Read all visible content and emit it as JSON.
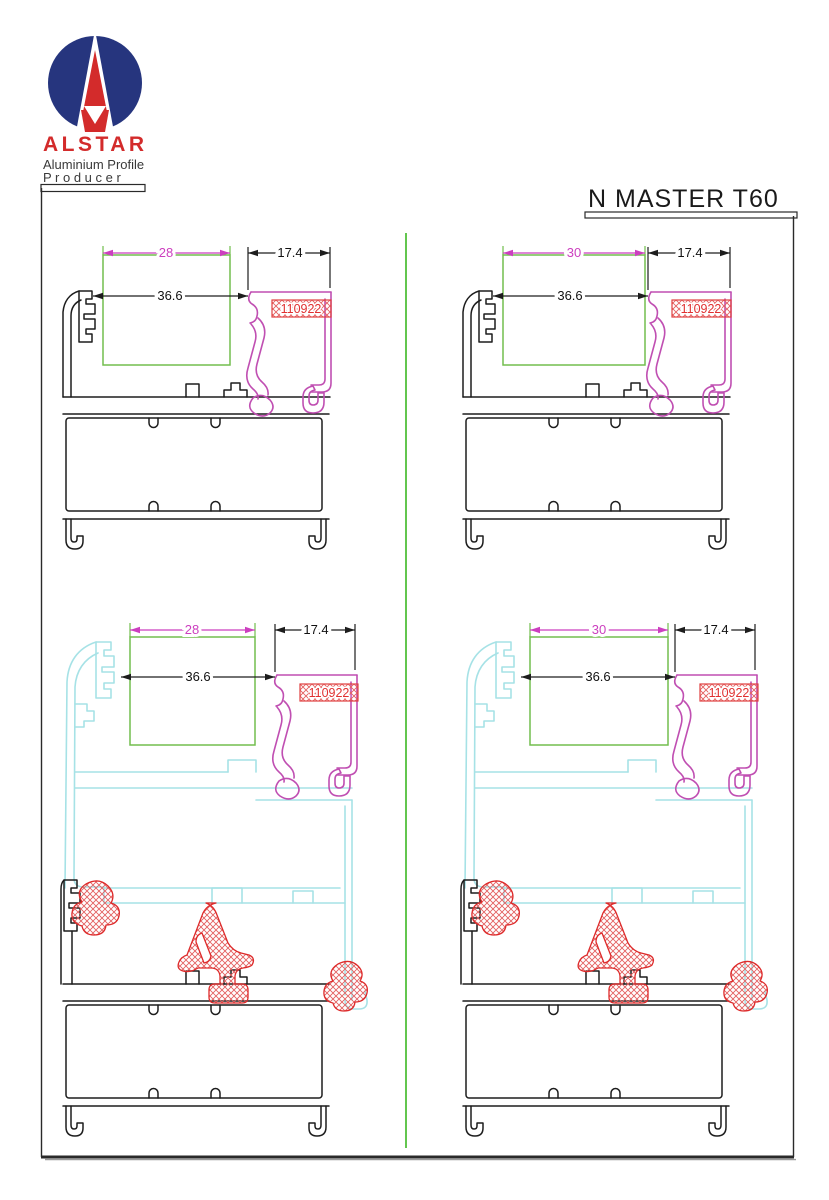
{
  "logo": {
    "brand": "ALSTAR",
    "tagline1": "Aluminium Profile",
    "tagline2": "P r o d u c e r"
  },
  "drawing_title": "N MASTER T60",
  "colors": {
    "frame_black": "#1d1d1d",
    "bead_magenta": "#c04fb2",
    "dim_magenta": "#cc3fbf",
    "glass_green": "#72be4e",
    "divider_green": "#63c64f",
    "sash_cyan": "#a6e2e6",
    "gasket_red": "#dd2a2a",
    "brand_navy": "#26357e",
    "brand_red": "#d32b2b"
  },
  "diagrams": [
    {
      "id": "top-left",
      "profile_code": "110922",
      "dims": {
        "glass": "28",
        "bead": "17.4",
        "inner": "36.6"
      }
    },
    {
      "id": "top-right",
      "profile_code": "110922",
      "dims": {
        "glass": "30",
        "bead": "17.4",
        "inner": "36.6"
      }
    },
    {
      "id": "bottom-left",
      "profile_code": "110922",
      "dims": {
        "glass": "28",
        "bead": "17.4",
        "inner": "36.6"
      }
    },
    {
      "id": "bottom-right",
      "profile_code": "110922",
      "dims": {
        "glass": "30",
        "bead": "17.4",
        "inner": "36.6"
      }
    }
  ]
}
